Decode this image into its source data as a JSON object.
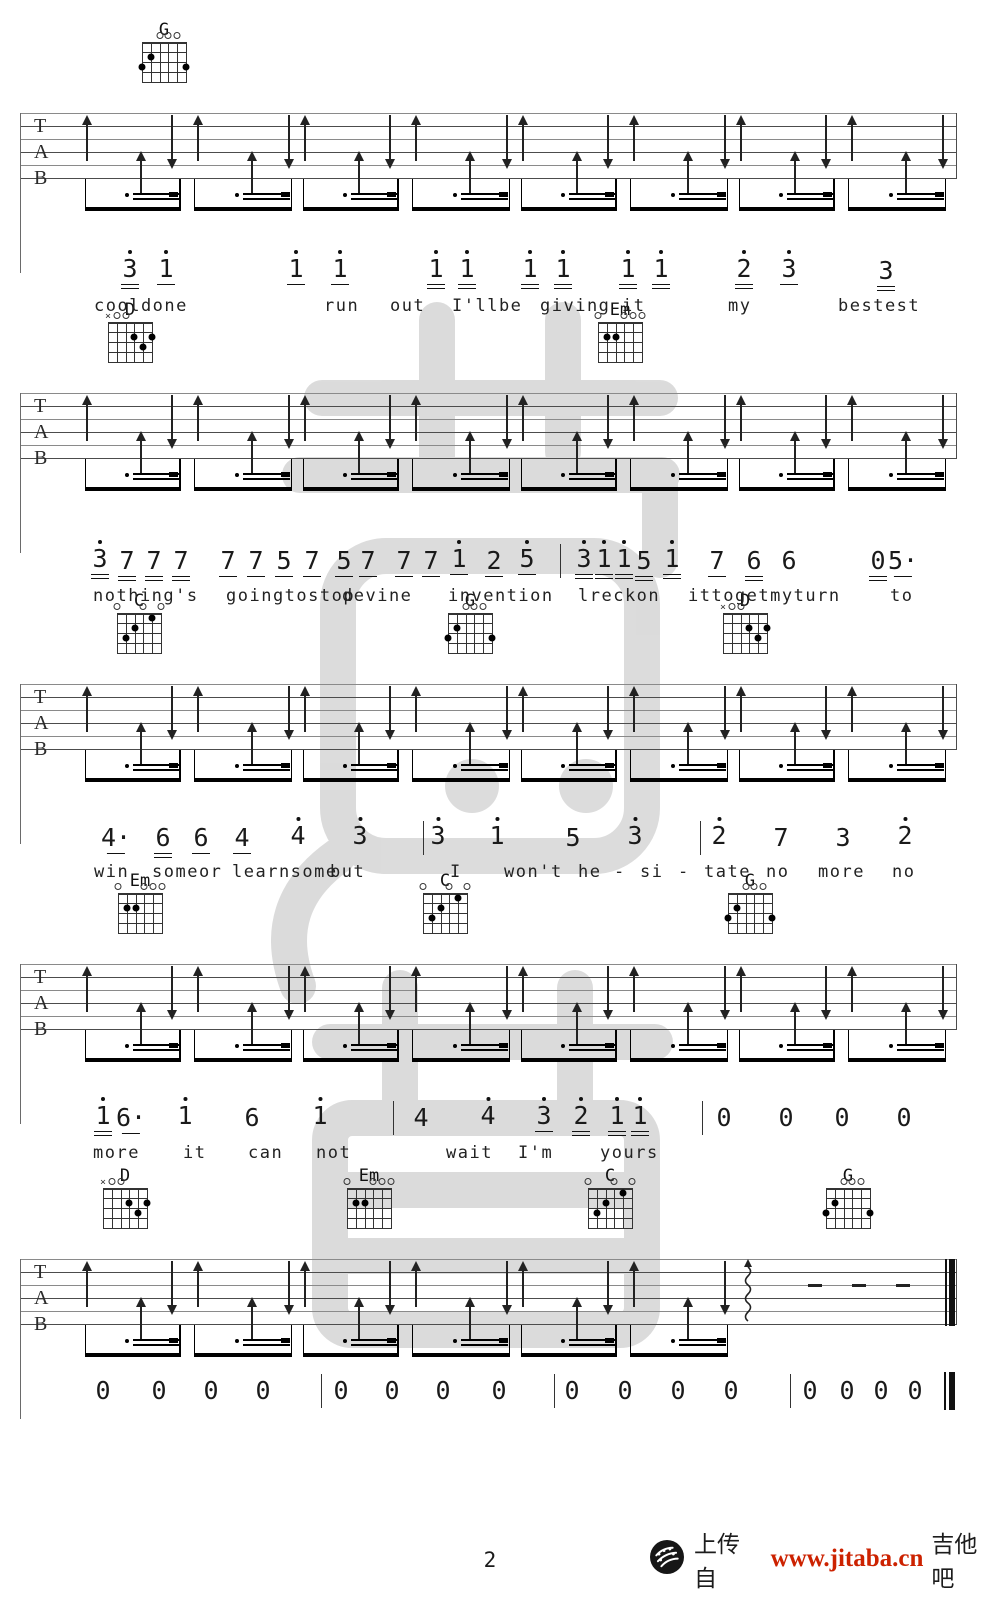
{
  "page": {
    "width": 1000,
    "height": 1600,
    "background": "#ffffff",
    "ink": "#1a1a1a",
    "page_number": "2"
  },
  "footer": {
    "upload_text": "上传自",
    "site_url": "www.jitaba.cn",
    "site_name": "吉他吧",
    "url_color": "#cc2200",
    "icon": "guitar-pick-icon"
  },
  "watermark": {
    "color": "#d2d2d2",
    "opacity": 0.78
  },
  "tab_letters": [
    "T",
    "A",
    "B"
  ],
  "chord_shapes": {
    "G": {
      "top": [
        "",
        "",
        "o",
        "o",
        "o",
        ""
      ],
      "dots": [
        [
          2,
          2
        ],
        [
          1,
          3
        ],
        [
          6,
          3
        ]
      ]
    },
    "D": {
      "top": [
        "x",
        "o",
        "o",
        "",
        "",
        ""
      ],
      "dots": [
        [
          4,
          2
        ],
        [
          6,
          2
        ],
        [
          5,
          3
        ]
      ]
    },
    "Em": {
      "top": [
        "o",
        "",
        "",
        "o",
        "o",
        "o"
      ],
      "dots": [
        [
          2,
          2
        ],
        [
          3,
          2
        ]
      ]
    },
    "C": {
      "top": [
        "o",
        "",
        "",
        "o",
        "",
        "o"
      ],
      "dots": [
        [
          5,
          1
        ],
        [
          3,
          2
        ],
        [
          2,
          3
        ]
      ]
    }
  },
  "systems": [
    {
      "staff_top": 113,
      "chords": [
        {
          "name": "G",
          "cx": 164
        }
      ]
    },
    {
      "staff_top": 393,
      "chords": [
        {
          "name": "D",
          "cx": 130
        },
        {
          "name": "Em",
          "cx": 620
        }
      ]
    },
    {
      "staff_top": 684,
      "chords": [
        {
          "name": "C",
          "cx": 139
        },
        {
          "name": "G",
          "cx": 470
        },
        {
          "name": "D",
          "cx": 745
        }
      ]
    },
    {
      "staff_top": 964,
      "chords": [
        {
          "name": "Em",
          "cx": 140
        },
        {
          "name": "C",
          "cx": 445
        },
        {
          "name": "G",
          "cx": 750
        }
      ]
    },
    {
      "staff_top": 1259,
      "chords": [
        {
          "name": "D",
          "cx": 125
        },
        {
          "name": "Em",
          "cx": 369
        },
        {
          "name": "C",
          "cx": 610
        },
        {
          "name": "G",
          "cx": 848
        }
      ],
      "last_measure_special": true
    }
  ],
  "melody_lines": [
    {
      "num_y": 258,
      "lyric_y": 298,
      "bars": [],
      "tokens": [
        {
          "v": "3",
          "d": 1,
          "u": 2,
          "x": 130
        },
        {
          "v": "1",
          "d": 1,
          "u": 1,
          "x": 166
        },
        {
          "v": "1",
          "d": 1,
          "u": 1,
          "x": 296
        },
        {
          "v": "1",
          "d": 1,
          "u": 1,
          "x": 340
        },
        {
          "v": "1",
          "d": 1,
          "u": 2,
          "x": 436
        },
        {
          "v": "1",
          "d": 1,
          "u": 2,
          "x": 467
        },
        {
          "v": "1",
          "d": 1,
          "u": 2,
          "x": 530
        },
        {
          "v": "1",
          "d": 1,
          "u": 2,
          "x": 563
        },
        {
          "v": "1",
          "d": 1,
          "u": 2,
          "x": 628
        },
        {
          "v": "1",
          "d": 1,
          "u": 2,
          "x": 661
        },
        {
          "v": "2",
          "d": 1,
          "u": 2,
          "x": 744
        },
        {
          "v": "3",
          "d": 1,
          "u": 1,
          "x": 789
        },
        {
          "v": "3",
          "d": 0,
          "u": 2,
          "x": 886
        }
      ],
      "lyrics": [
        {
          "t": "cooldone",
          "x": 94
        },
        {
          "t": "run",
          "x": 324
        },
        {
          "t": "out",
          "x": 390
        },
        {
          "t": "I'llbe",
          "x": 452
        },
        {
          "t": "giving",
          "x": 540
        },
        {
          "t": "it",
          "x": 622
        },
        {
          "t": "my",
          "x": 728
        },
        {
          "t": "bestest",
          "x": 838
        }
      ]
    },
    {
      "num_y": 548,
      "lyric_y": 588,
      "bars": [
        560
      ],
      "tokens": [
        {
          "v": "3",
          "d": 1,
          "u": 2,
          "x": 100
        },
        {
          "v": "7",
          "u": 2,
          "x": 127
        },
        {
          "v": "7",
          "u": 2,
          "x": 154
        },
        {
          "v": "7",
          "u": 2,
          "x": 181
        },
        {
          "v": "7",
          "u": 1,
          "x": 228
        },
        {
          "v": "7",
          "u": 1,
          "x": 256
        },
        {
          "v": "5",
          "u": 1,
          "x": 284
        },
        {
          "v": "7",
          "u": 1,
          "x": 312
        },
        {
          "v": "5",
          "u": 1,
          "x": 344
        },
        {
          "v": "7",
          "u": 1,
          "x": 368
        },
        {
          "v": "7",
          "u": 1,
          "x": 404
        },
        {
          "v": "7",
          "u": 1,
          "x": 431
        },
        {
          "v": "1",
          "d": 1,
          "u": 1,
          "x": 459
        },
        {
          "v": "2",
          "u": 1,
          "x": 494
        },
        {
          "v": "5",
          "d": 1,
          "u": 1,
          "x": 527
        },
        {
          "v": "3",
          "d": 1,
          "u": 2,
          "x": 584
        },
        {
          "v": "1",
          "d": 1,
          "u": 2,
          "x": 604
        },
        {
          "v": "1",
          "d": 1,
          "u": 2,
          "x": 624
        },
        {
          "v": "5",
          "u": 2,
          "x": 644
        },
        {
          "v": "1",
          "d": 1,
          "u": 2,
          "x": 672
        },
        {
          "v": "7",
          "u": 1,
          "x": 717
        },
        {
          "v": "6",
          "u": 2,
          "x": 754
        },
        {
          "v": "6",
          "u": 0,
          "x": 789
        },
        {
          "v": "0",
          "u": 2,
          "x": 878
        },
        {
          "v": "5",
          "u": 1,
          "ad": 1,
          "x": 903
        }
      ],
      "lyrics": [
        {
          "t": "nothing's",
          "x": 93
        },
        {
          "t": "goingtostop",
          "x": 226
        },
        {
          "t": "devine",
          "x": 342
        },
        {
          "t": "invention",
          "x": 448
        },
        {
          "t": "lreckon",
          "x": 578
        },
        {
          "t": "ittogetmyturn",
          "x": 688
        },
        {
          "t": "to",
          "x": 890
        }
      ]
    },
    {
      "num_y": 825,
      "lyric_y": 864,
      "bars": [
        423,
        700
      ],
      "tokens": [
        {
          "v": "4",
          "u": 1,
          "ad": 1,
          "x": 116
        },
        {
          "v": "6",
          "u": 2,
          "x": 163
        },
        {
          "v": "6",
          "u": 1,
          "x": 201
        },
        {
          "v": "4",
          "u": 1,
          "x": 242
        },
        {
          "v": "4",
          "d": 1,
          "x": 298
        },
        {
          "v": "3",
          "d": 1,
          "x": 360
        },
        {
          "v": "3",
          "d": 1,
          "x": 438
        },
        {
          "v": "1",
          "d": 1,
          "x": 497
        },
        {
          "v": "5",
          "x": 573
        },
        {
          "v": "3",
          "d": 1,
          "x": 635
        },
        {
          "v": "2",
          "d": 1,
          "x": 719
        },
        {
          "v": "7",
          "x": 781
        },
        {
          "v": "3",
          "x": 843
        },
        {
          "v": "2",
          "d": 1,
          "x": 905
        }
      ],
      "lyrics": [
        {
          "t": "win",
          "x": 94
        },
        {
          "t": "someor",
          "x": 152
        },
        {
          "t": "learnsome",
          "x": 232
        },
        {
          "t": "but",
          "x": 330
        },
        {
          "t": "I",
          "x": 450
        },
        {
          "t": "won't",
          "x": 504
        },
        {
          "t": "he",
          "x": 578
        },
        {
          "t": "-",
          "x": 614
        },
        {
          "t": "si",
          "x": 640
        },
        {
          "t": "-",
          "x": 678
        },
        {
          "t": "tate",
          "x": 704
        },
        {
          "t": "no",
          "x": 766
        },
        {
          "t": "more",
          "x": 818
        },
        {
          "t": "no",
          "x": 892
        }
      ]
    },
    {
      "num_y": 1105,
      "lyric_y": 1145,
      "bars": [
        393,
        702
      ],
      "tokens": [
        {
          "v": "1",
          "d": 1,
          "u": 2,
          "x": 103
        },
        {
          "v": "6",
          "u": 1,
          "ad": 1,
          "x": 131
        },
        {
          "v": "1",
          "d": 1,
          "x": 185
        },
        {
          "v": "6",
          "x": 252
        },
        {
          "v": "1",
          "d": 1,
          "x": 320
        },
        {
          "v": "4",
          "x": 421
        },
        {
          "v": "4",
          "d": 1,
          "x": 488
        },
        {
          "v": "3",
          "d": 1,
          "u": 1,
          "x": 544
        },
        {
          "v": "2",
          "d": 1,
          "u": 2,
          "x": 581
        },
        {
          "v": "1",
          "d": 1,
          "u": 2,
          "x": 617
        },
        {
          "v": "1",
          "d": 1,
          "u": 2,
          "x": 640
        },
        {
          "v": "0",
          "x": 724
        },
        {
          "v": "0",
          "x": 786
        },
        {
          "v": "0",
          "x": 842
        },
        {
          "v": "0",
          "x": 904
        }
      ],
      "lyrics": [
        {
          "t": "more",
          "x": 93
        },
        {
          "t": "it",
          "x": 183
        },
        {
          "t": "can",
          "x": 248
        },
        {
          "t": "not",
          "x": 316
        },
        {
          "t": "wait",
          "x": 446
        },
        {
          "t": "I'm",
          "x": 518
        },
        {
          "t": "yours",
          "x": 600
        }
      ]
    },
    {
      "num_y": 1378,
      "lyric_y": null,
      "bars": [
        321,
        554,
        790
      ],
      "end_bar_x": 944,
      "tokens": [
        {
          "v": "0",
          "x": 103
        },
        {
          "v": "0",
          "x": 159
        },
        {
          "v": "0",
          "x": 211
        },
        {
          "v": "0",
          "x": 263
        },
        {
          "v": "0",
          "x": 341
        },
        {
          "v": "0",
          "x": 392
        },
        {
          "v": "0",
          "x": 443
        },
        {
          "v": "0",
          "x": 499
        },
        {
          "v": "0",
          "x": 572
        },
        {
          "v": "0",
          "x": 625
        },
        {
          "v": "0",
          "x": 678
        },
        {
          "v": "0",
          "x": 731
        },
        {
          "v": "0",
          "x": 810
        },
        {
          "v": "0",
          "x": 847
        },
        {
          "v": "0",
          "x": 881
        },
        {
          "v": "0",
          "x": 915
        }
      ],
      "lyrics": []
    }
  ],
  "notation": {
    "staff_left": 20,
    "staff_right": 956,
    "line_gap": 13,
    "lines": 6,
    "music_x0": 78,
    "music_x1": 950,
    "measures_per_system": 4,
    "arrow_slots": [
      {
        "f": 0.04,
        "t": "tall-up"
      },
      {
        "f": 0.29,
        "t": "small-up"
      },
      {
        "f": 0.43,
        "t": "down"
      },
      {
        "f": 0.55,
        "t": "tall-up"
      },
      {
        "f": 0.8,
        "t": "small-up"
      },
      {
        "f": 0.97,
        "t": "down"
      }
    ],
    "beam_groups": [
      {
        "gx": 0.03,
        "gw": 0.44
      },
      {
        "gx": 0.53,
        "gw": 0.45
      }
    ],
    "special_last_measure": {
      "squiggle_f": 0.04,
      "dash_fs": [
        0.35,
        0.55,
        0.75
      ]
    }
  }
}
